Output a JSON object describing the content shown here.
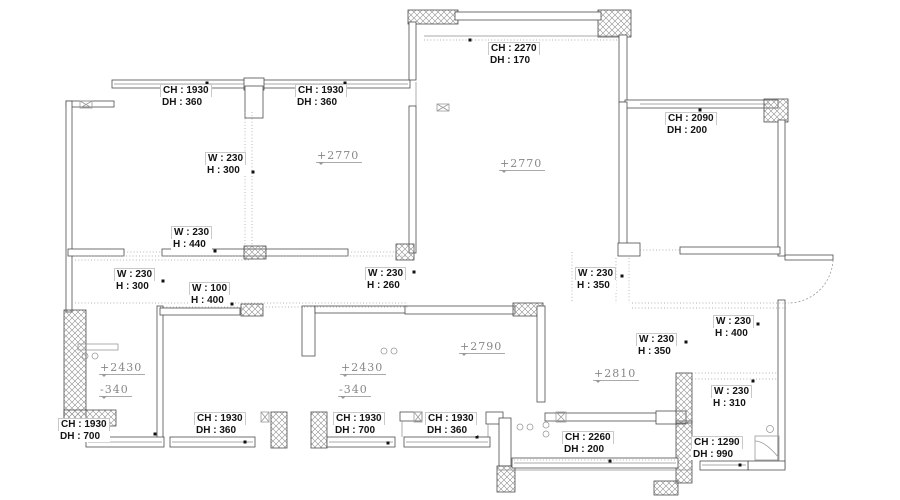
{
  "drawing": {
    "type": "apartment-floor-plan",
    "background": "#ffffff",
    "colors": {
      "wall_line": "#4d4d4d",
      "thin_line": "#8b8b8b",
      "dashed_line": "#9a9a9a",
      "dimension_text": "#141414",
      "level_text": "#878787"
    }
  },
  "labels": {
    "win_top_left_1": {
      "l1": "CH : 1930",
      "l2": "DH : 360"
    },
    "win_top_left_2": {
      "l1": "CH : 1930",
      "l2": "DH : 360"
    },
    "win_top_center": {
      "l1": "CH : 2270",
      "l2": "DH : 170"
    },
    "win_top_right": {
      "l1": "CH : 2090",
      "l2": "DH : 200"
    },
    "beam_a": {
      "l1": "W : 230",
      "l2": "H : 300"
    },
    "beam_b": {
      "l1": "W : 230",
      "l2": "H : 440"
    },
    "beam_c": {
      "l1": "W : 230",
      "l2": "H : 300"
    },
    "beam_d": {
      "l1": "W : 100",
      "l2": "H : 400"
    },
    "beam_e": {
      "l1": "W : 230",
      "l2": "H : 260"
    },
    "beam_f": {
      "l1": "W : 230",
      "l2": "H : 350"
    },
    "beam_g": {
      "l1": "W : 230",
      "l2": "H : 350"
    },
    "beam_h": {
      "l1": "W : 230",
      "l2": "H : 400"
    },
    "beam_i": {
      "l1": "W : 230",
      "l2": "H : 310"
    },
    "win_bottom_left_1": {
      "l1": "CH : 1930",
      "l2": "DH : 700"
    },
    "win_bottom_left_2": {
      "l1": "CH : 1930",
      "l2": "DH : 360"
    },
    "win_bottom_mid_1": {
      "l1": "CH : 1930",
      "l2": "DH : 700"
    },
    "win_bottom_mid_2": {
      "l1": "CH : 1930",
      "l2": "DH : 360"
    },
    "win_balcony": {
      "l1": "CH : 2260",
      "l2": "DH : 200"
    },
    "win_bottom_right": {
      "l1": "CH : 1290",
      "l2": "DH : 990"
    },
    "level_bedroom_left": "+2770",
    "level_living": "+2770",
    "level_bath_left_top": "+2430",
    "level_bath_left_bottom": "-340",
    "level_bath_mid_top": "+2430",
    "level_bath_mid_bottom": "-340",
    "level_kitchen": "+2790",
    "level_dining": "+2810"
  }
}
